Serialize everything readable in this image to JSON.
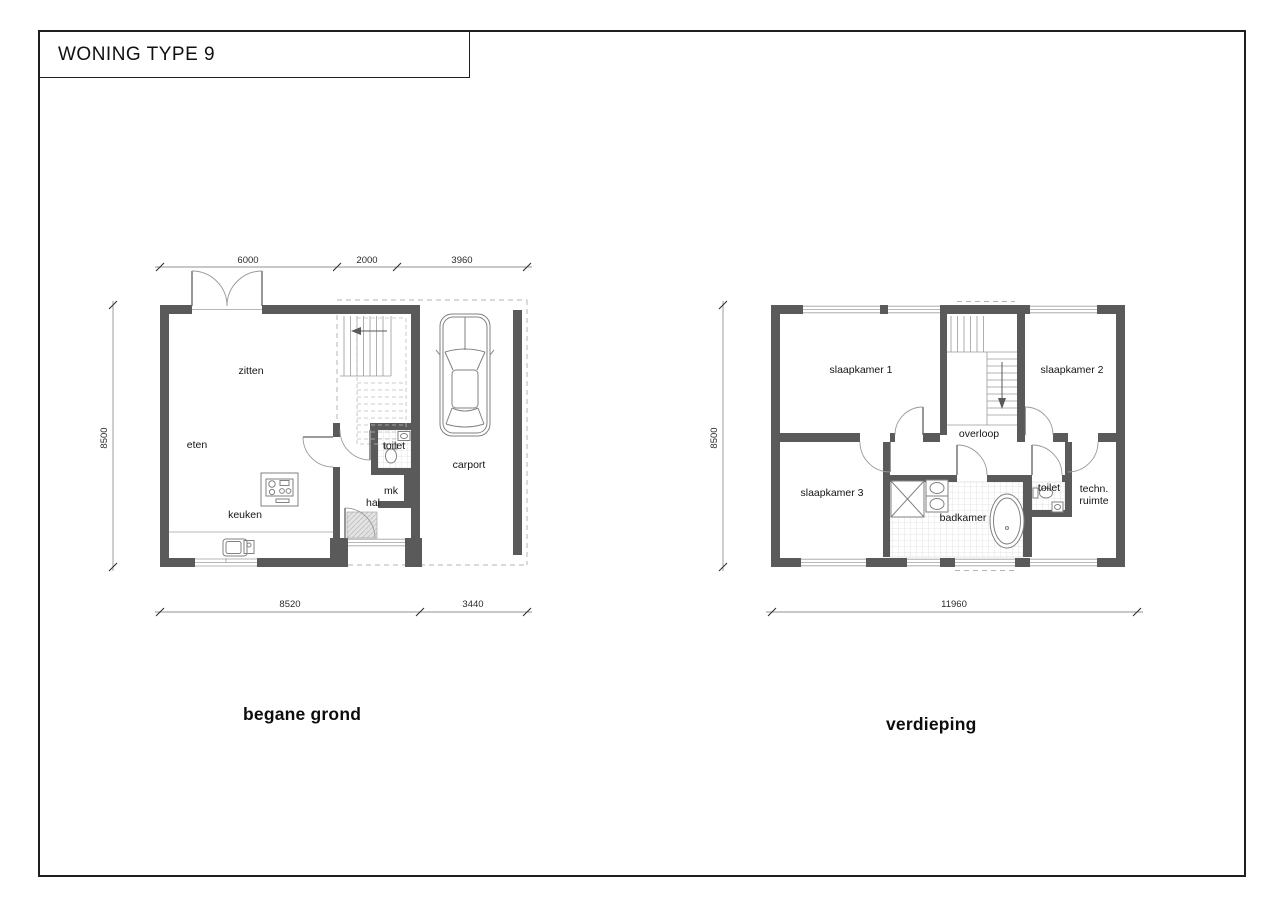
{
  "title": "WONING TYPE 9",
  "colors": {
    "wall": "#5a5a5a",
    "frame": "#1f1f1f",
    "tile": "#dcdcdc",
    "dashed": "#b5b5b5"
  },
  "ground": {
    "caption": "begane grond",
    "labels": {
      "zitten": "zitten",
      "eten": "eten",
      "keuken": "keuken",
      "hal": "hal",
      "toilet": "toilet",
      "mk": "mk",
      "carport": "carport"
    },
    "dims": {
      "top1": "6000",
      "top2": "2000",
      "top3": "3960",
      "left": "8500",
      "bottom1": "8520",
      "bottom2": "3440"
    }
  },
  "upper": {
    "caption": "verdieping",
    "labels": {
      "slaapkamer1": "slaapkamer 1",
      "slaapkamer2": "slaapkamer 2",
      "slaapkamer3": "slaapkamer 3",
      "overloop": "overloop",
      "badkamer": "badkamer",
      "toilet": "toilet",
      "techn_line1": "techn.",
      "techn_line2": "ruimte"
    },
    "dims": {
      "left": "8500",
      "bottom": "11960"
    }
  }
}
